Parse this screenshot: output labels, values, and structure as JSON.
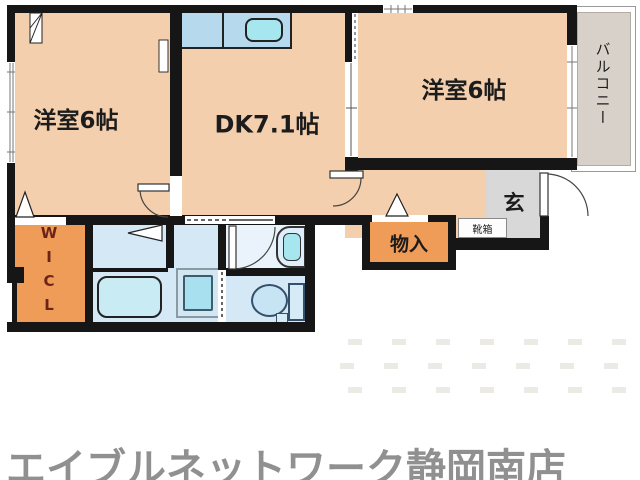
{
  "labels": {
    "bedroom1": "洋室6帖",
    "dk": "DK7.1帖",
    "bedroom2": "洋室6帖",
    "balcony": "バルコニー",
    "entrance": "玄",
    "shoe_box": "靴箱",
    "storage": "物入",
    "wicl": "WICL"
  },
  "fixtures": [
    "kitchen-sink",
    "bathtub",
    "washing-machine-pan",
    "washbasin",
    "toilet"
  ],
  "footer": {
    "store_name": "エイブルネットワーク静岡南店"
  },
  "colors": {
    "wall": "#161616",
    "room_floor": "#f4cfad",
    "closet_orange": "#ef9c58",
    "wet_area_blue": "#d5e8f5",
    "fixture_cyan": "#a5e6ef",
    "entrance_gray": "#d8d8d8",
    "balcony_gray": "#d8d1c9",
    "brand_text": "#909090",
    "wicl_text": "#6b2417"
  }
}
